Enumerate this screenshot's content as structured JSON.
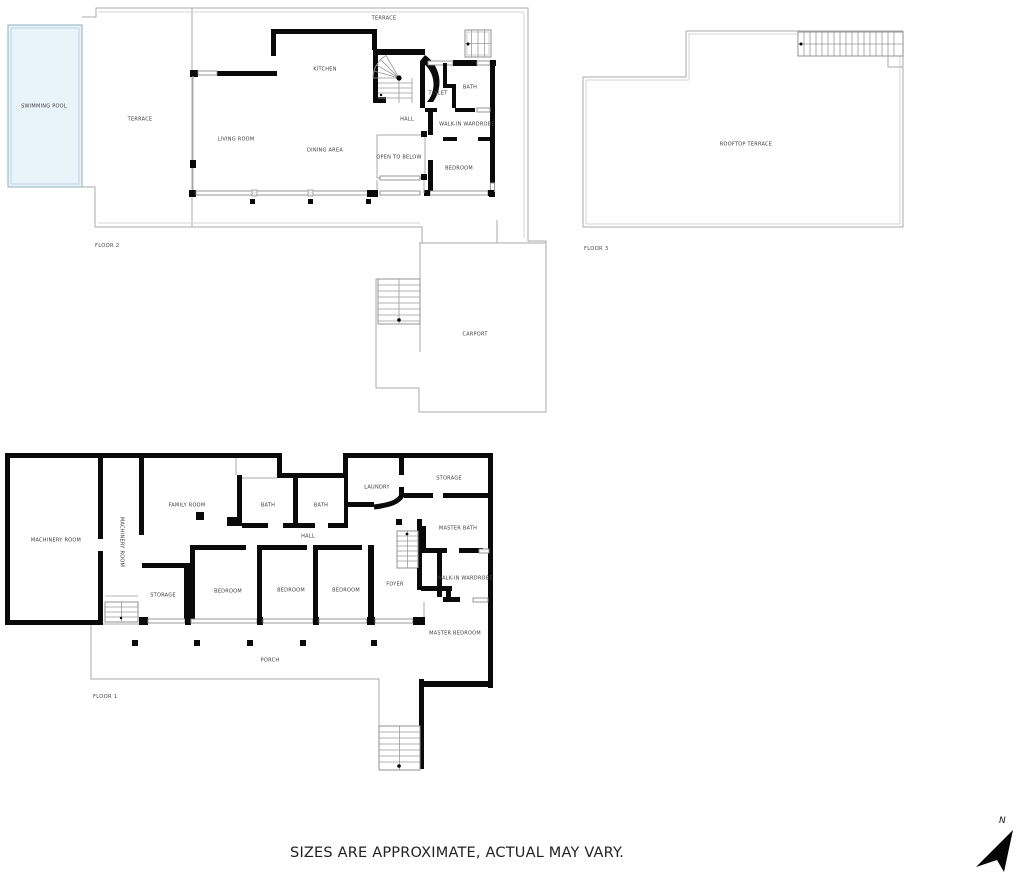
{
  "meta": {
    "caption": "SIZES ARE APPROXIMATE, ACTUAL MAY VARY.",
    "compass_label": "N"
  },
  "colors": {
    "pool_fill": "#e9f3fa",
    "wall": "#0a0a0a",
    "outline": "#a8a8a8"
  },
  "floor2": {
    "label": "FLOOR 2",
    "rooms": {
      "swimming_pool": "SWIMMING POOL",
      "terrace_left": "TERRACE",
      "terrace_top": "TERRACE",
      "living_room": "LIVING ROOM",
      "kitchen": "KITCHEN",
      "dining_area": "DINING AREA",
      "hall": "HALL",
      "open_to_below": "OPEN TO BELOW",
      "toilet": "TOILET",
      "bath": "BATH",
      "walk_in_wardrobe": "WALK-IN WARDROBE",
      "bedroom": "BEDROOM",
      "carport": "CARPORT"
    }
  },
  "floor3": {
    "label": "FLOOR 3",
    "rooms": {
      "rooftop_terrace": "ROOFTOP TERRACE"
    }
  },
  "floor1": {
    "label": "FLOOR 1",
    "rooms": {
      "machinery_room": "MACHINERY ROOM",
      "machinery_room_vertical": "MACHINERY ROOM",
      "family_room": "FAMILY ROOM",
      "bath_1": "BATH",
      "bath_2": "BATH",
      "laundry": "LAUNDRY",
      "storage_upper": "STORAGE",
      "master_bath": "MASTER BATH",
      "hall": "HALL",
      "storage_lower": "STORAGE",
      "bedroom_1": "BEDROOM",
      "bedroom_2": "BEDROOM",
      "bedroom_3": "BEDROOM",
      "foyer": "FOYER",
      "walk_in_wardrobe": "WALK-IN WARDROBE",
      "master_bedroom": "MASTER BEDROOM",
      "porch": "PORCH"
    }
  }
}
